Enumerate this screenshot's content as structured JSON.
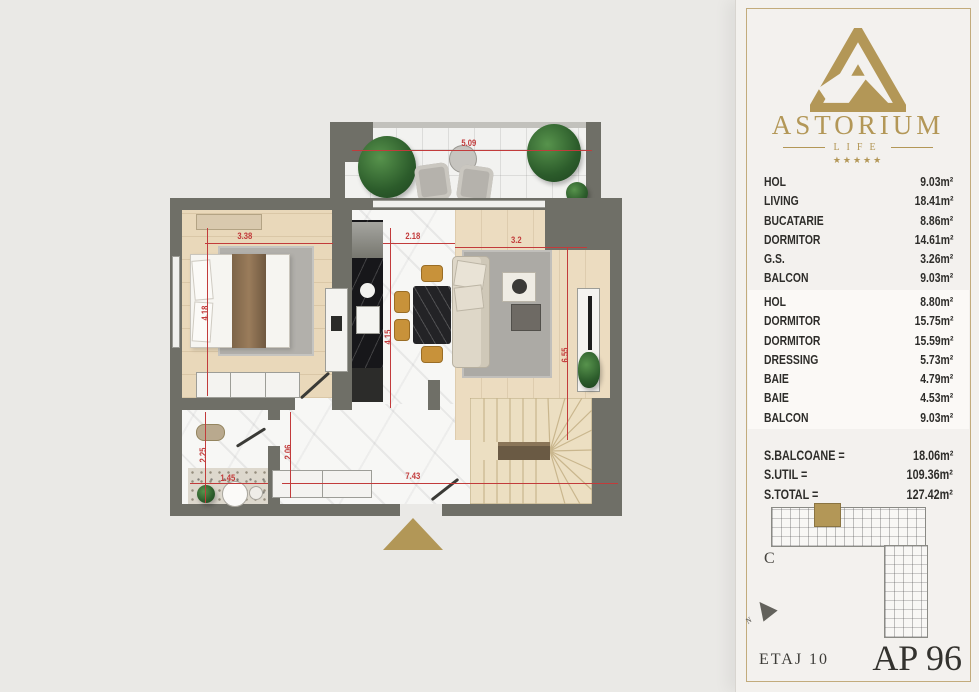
{
  "colors": {
    "brand_gold": "#b39757",
    "dim_red": "#c23b3b",
    "wall_gray": "#6f6f67"
  },
  "panel": {
    "brand": {
      "name": "ASTORIUM",
      "tagline": "LIFE",
      "stars": "★★★★★"
    },
    "areas_top": [
      {
        "label": "HOL",
        "value": "9.03m²"
      },
      {
        "label": "LIVING",
        "value": "18.41m²"
      },
      {
        "label": "BUCATARIE",
        "value": "8.86m²"
      },
      {
        "label": "DORMITOR",
        "value": "14.61m²"
      },
      {
        "label": "G.S.",
        "value": "3.26m²"
      },
      {
        "label": "BALCON",
        "value": "9.03m²"
      }
    ],
    "areas_bottom": [
      {
        "label": "HOL",
        "value": "8.80m²"
      },
      {
        "label": "DORMITOR",
        "value": "15.75m²"
      },
      {
        "label": "DORMITOR",
        "value": "15.59m²"
      },
      {
        "label": "DRESSING",
        "value": "5.73m²"
      },
      {
        "label": "BAIE",
        "value": "4.79m²"
      },
      {
        "label": "BAIE",
        "value": "4.53m²"
      },
      {
        "label": "BALCON",
        "value": "9.03m²"
      }
    ],
    "totals": [
      {
        "label": "S.BALCOANE =",
        "value": "18.06m²"
      },
      {
        "label": "S.UTIL =",
        "value": "109.36m²"
      },
      {
        "label": "S.TOTAL =",
        "value": "127.42m²"
      }
    ],
    "map": {
      "section_label": "C",
      "north_label": "N"
    },
    "footer": {
      "floor": "ETAJ 10",
      "apartment": "AP 96"
    }
  },
  "plan": {
    "dims": {
      "balcony_w": "5.09",
      "bedroom_w": "3.38",
      "kitchen_w": "2.18",
      "living_w": "3.2",
      "bedroom_h": "4.18",
      "kitchen_h": "4.15",
      "living_h": "6.55",
      "bath_h": "2.25",
      "hall_h": "2.06",
      "bath_w": "1.45",
      "bottom_w": "7.43"
    }
  }
}
